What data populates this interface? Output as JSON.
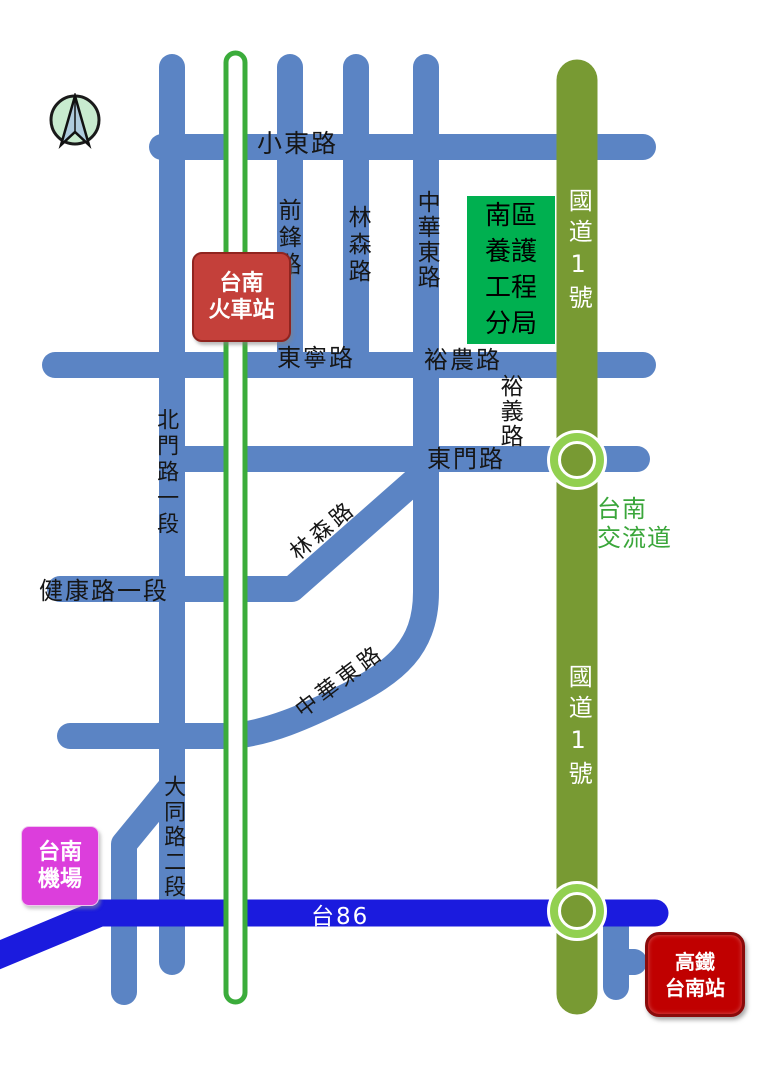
{
  "map_type": "schematic-road-map-tainan",
  "icons": {
    "compass": "north-arrow-compass-icon"
  },
  "colors": {
    "local_road": "#5B84C4",
    "railway_green": "#3BAC3B",
    "national_highway_green": "#789A33",
    "interchange_ring_green": "#92D050",
    "expressway_blue": "#1B1BDE",
    "train_station_red": "#C4403A",
    "hsr_station_red": "#C00000",
    "airport_magenta": "#DC3EDC",
    "office_green": "#00B050",
    "interchange_text_green": "#3AA63A"
  },
  "landmarks": {
    "train_station": {
      "line1": "台南",
      "line2": "火車站"
    },
    "office": {
      "line1": "南區",
      "line2": "養護",
      "line3": "工程",
      "line4": "分局"
    },
    "airport": {
      "line1": "台南",
      "line2": "機場"
    },
    "hsr_station": {
      "line1": "高鐵",
      "line2": "台南站"
    },
    "interchange": {
      "line1": "台南",
      "line2": "交流道"
    }
  },
  "roads": {
    "xiaodong": "小東路",
    "qianfeng": "前鋒路",
    "linsen_north": "林森路",
    "zhonghua_east_north": "中華東路",
    "dongning": "東寧路",
    "yunong": "裕農路",
    "yuyi": "裕義路",
    "dongmen": "東門路",
    "beimen_sec1": "北門路一段",
    "linsen_diagonal": "林森路",
    "jiankang_sec1": "健康路一段",
    "zhonghua_east_diagonal": "中華東路",
    "datong_sec2": "大同路二段"
  },
  "highways": {
    "national1_north": "國道1號",
    "national1_south": "國道1號",
    "tai86": "台86"
  }
}
